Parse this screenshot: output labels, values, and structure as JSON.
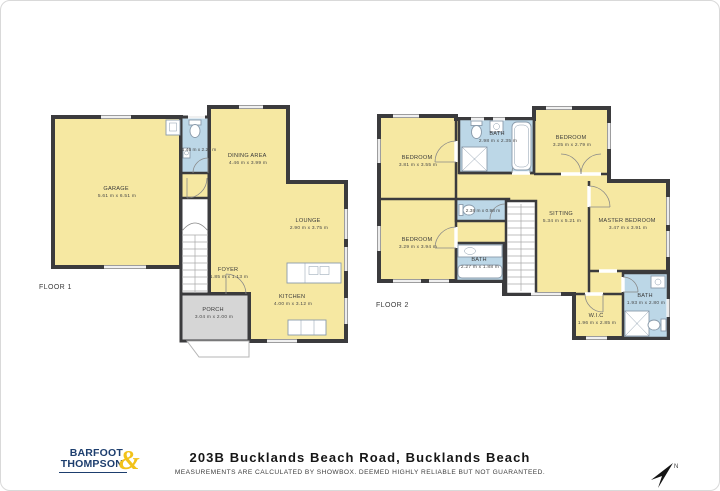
{
  "floor1": {
    "label": "FLOOR 1",
    "rooms": {
      "garage": {
        "name": "GARAGE",
        "dims": "5.61 m x 6.51 m"
      },
      "wc": {
        "dims": "1.46 m x 2.20 m"
      },
      "dining": {
        "name": "DINING AREA",
        "dims": "4.46 m x 3.99 m"
      },
      "lounge": {
        "name": "LOUNGE",
        "dims": "2.90 m x 3.75 m"
      },
      "foyer": {
        "name": "FOYER",
        "dims": "1.85 m x 1.13 m"
      },
      "kitchen": {
        "name": "KITCHEN",
        "dims": "4.00 m x 3.12 m"
      },
      "porch": {
        "name": "PORCH",
        "dims": "3.04 m x 2.00 m"
      }
    }
  },
  "floor2": {
    "label": "FLOOR 2",
    "rooms": {
      "bedroom_top_left": {
        "name": "BEDROOM",
        "dims": "3.81 m x 3.55 m"
      },
      "bath_top": {
        "name": "BATH",
        "dims": "2.98 m x 2.35 m"
      },
      "bedroom_top_right": {
        "name": "BEDROOM",
        "dims": "3.25 m x 2.79 m"
      },
      "hall_wc": {
        "dims": "2.38 m x 0.98 m"
      },
      "bedroom_left": {
        "name": "BEDROOM",
        "dims": "3.29 m x 3.94 m"
      },
      "bath_left": {
        "name": "BATH",
        "dims": "2.27 m x 1.88 m"
      },
      "sitting": {
        "name": "SITTING",
        "dims": "5.34 m x 5.21 m"
      },
      "master_bedroom": {
        "name": "MASTER BEDROOM",
        "dims": "3.47 m x 3.91 m"
      },
      "wic": {
        "name": "W.I.C",
        "dims": "1.96 m x 2.85 m"
      },
      "bath_right": {
        "name": "BATH",
        "dims": "1.93 m x 2.80 m"
      }
    }
  },
  "footer": {
    "brand_line1": "BARFOOT",
    "brand_line2": "THOMPSON",
    "brand_amp": "&",
    "title": "203B Bucklands Beach Road, Bucklands Beach",
    "disclaimer": "MEASUREMENTS ARE CALCULATED BY SHOWBOX. DEEMED HIGHLY RELIABLE BUT NOT GUARANTEED."
  },
  "compass": {
    "label": "N"
  },
  "colors": {
    "room_fill": "#F6E8A2",
    "bath_fill": "#BCD7E7",
    "wall": "#3B3B3D",
    "porch_fill": "#D6D6D6",
    "brand_navy": "#1D3E6E",
    "brand_gold": "#F2C21A"
  }
}
